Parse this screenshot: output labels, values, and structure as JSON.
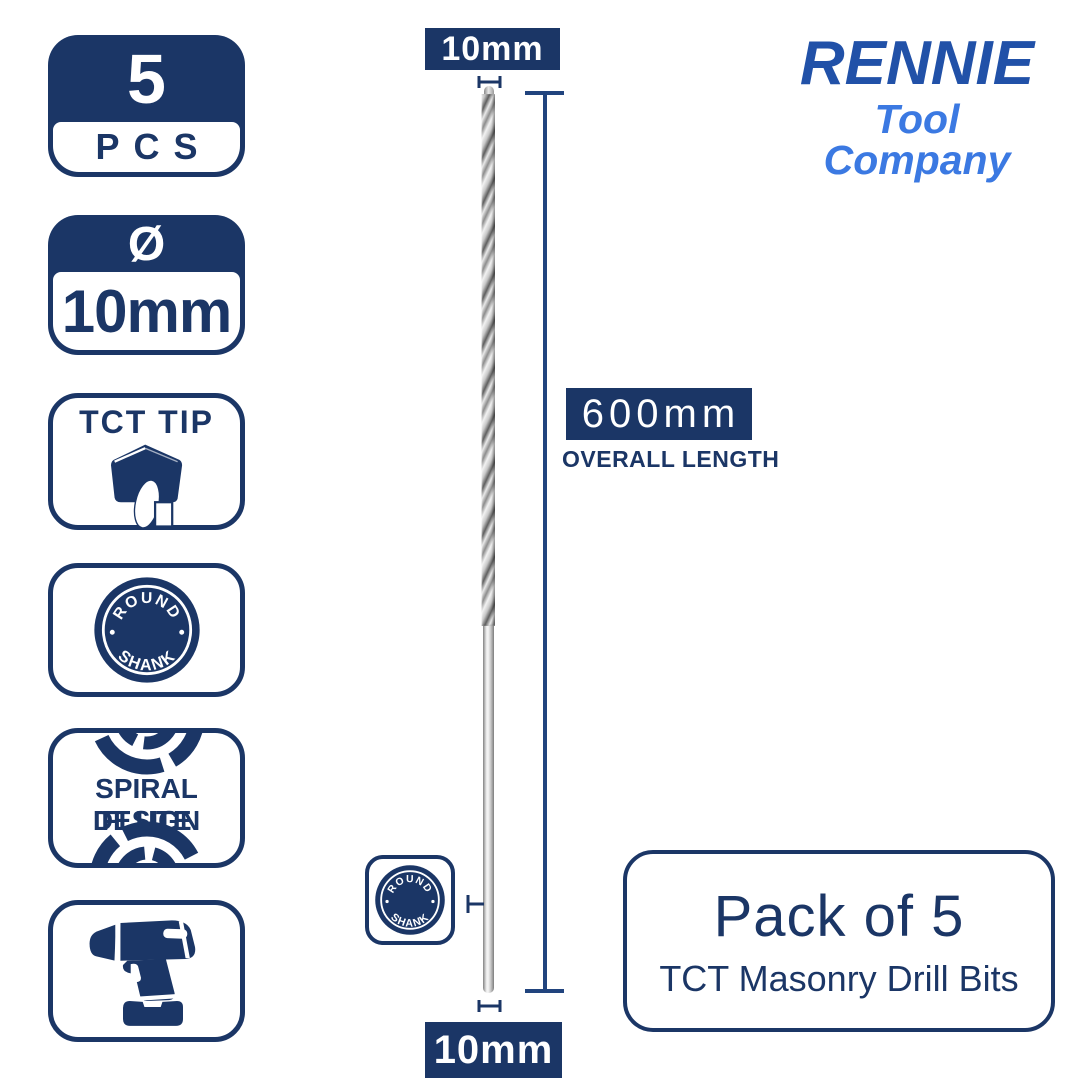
{
  "colors": {
    "navy": "#1b3666",
    "dimension_line": "#21447e",
    "logo_primary": "#2151a8",
    "logo_secondary": "#3b79e2",
    "background": "#ffffff"
  },
  "logo": {
    "brand": "RENNIE",
    "tagline": "Tool Company"
  },
  "badges": {
    "pcs": {
      "count": "5",
      "label": "PCS"
    },
    "diameter": {
      "symbol": "Ø",
      "value": "10mm"
    },
    "tct_tip": {
      "label": "TCT TIP"
    },
    "round_shank": {
      "top": "ROUND",
      "bottom": "SHANK"
    },
    "spiral_flute": {
      "line1": "SPIRAL FLUTE",
      "line2": "DESIGN"
    }
  },
  "measurements": {
    "diameter_top": "10mm",
    "diameter_bottom": "10mm",
    "overall_length": "600mm",
    "overall_length_label": "OVERALL LENGTH"
  },
  "product": {
    "title": "Pack of 5",
    "subtitle": "TCT Masonry Drill Bits"
  }
}
